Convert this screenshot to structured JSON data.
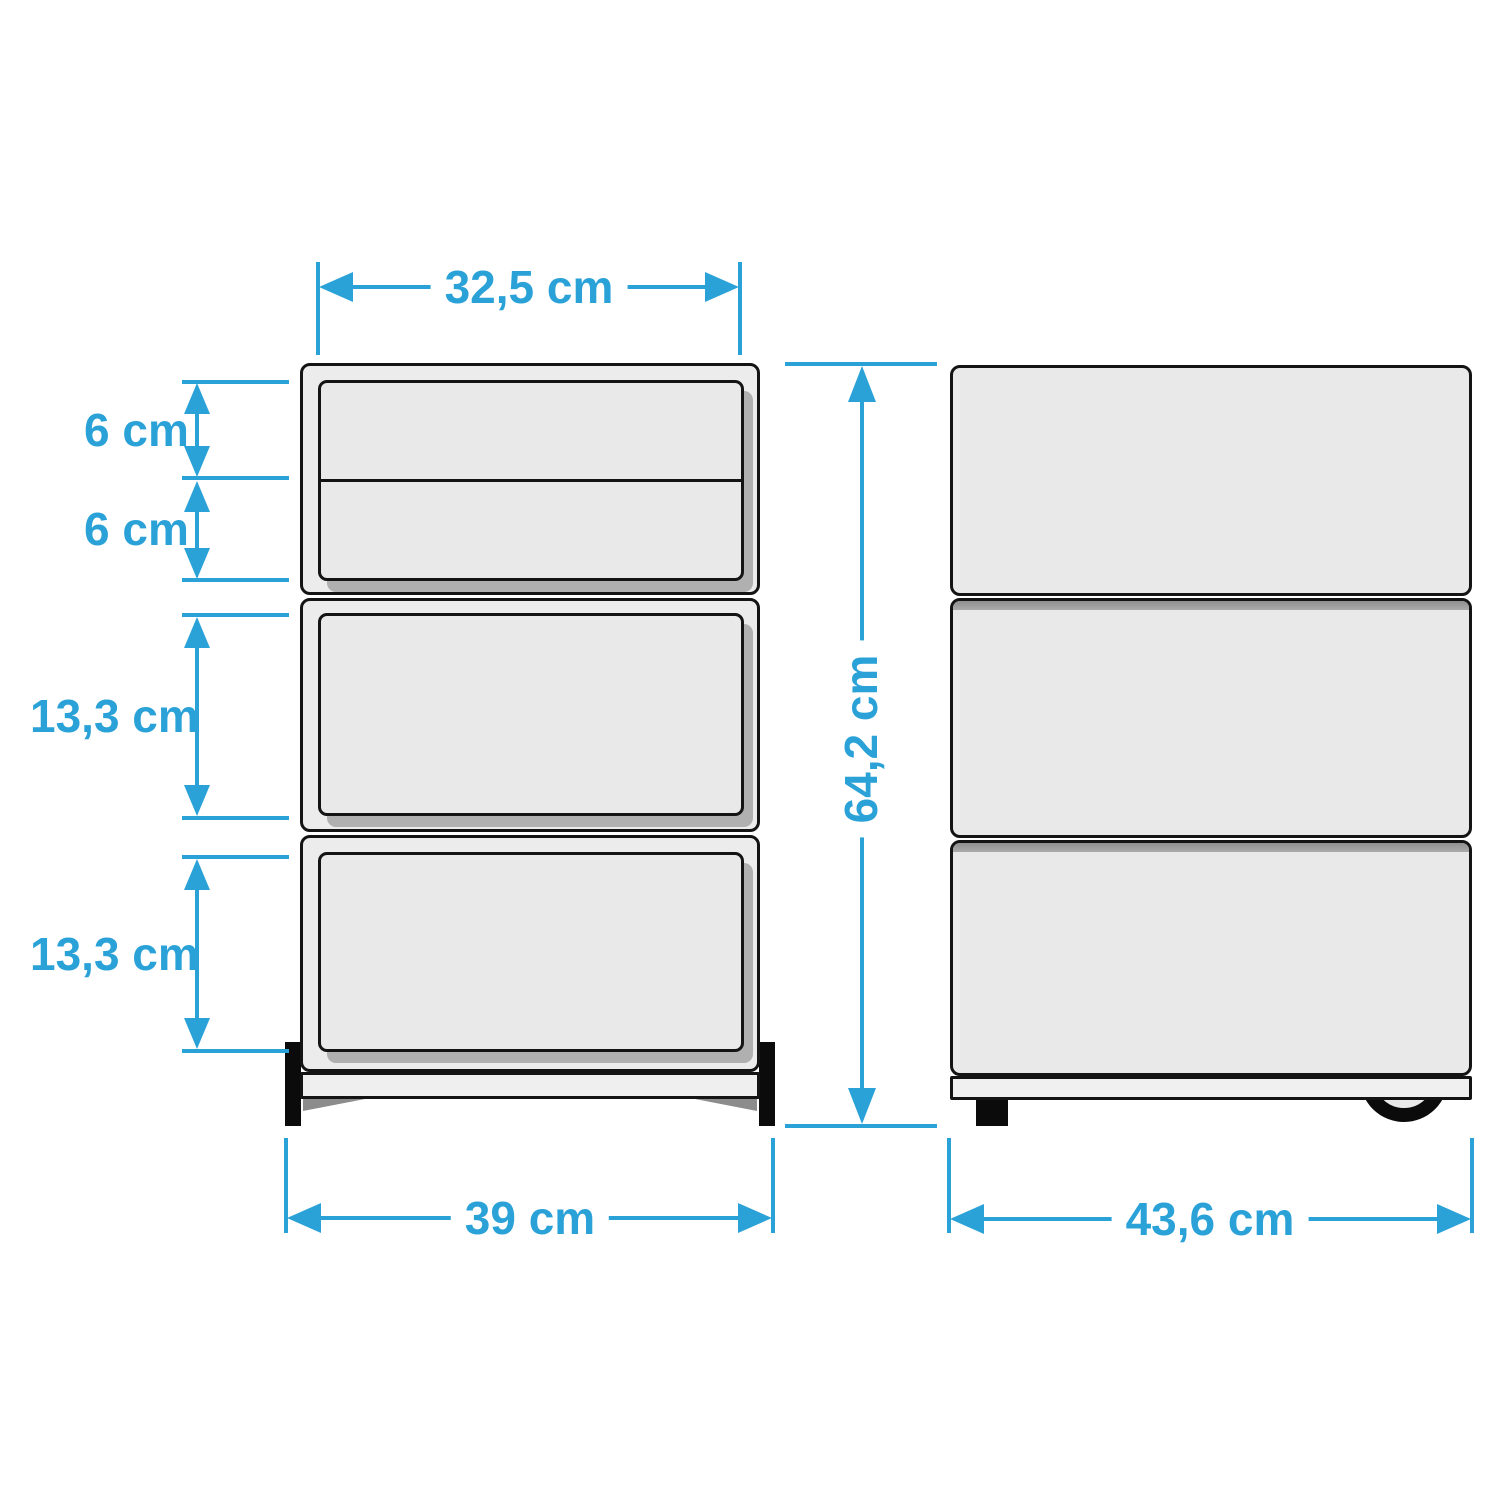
{
  "diagram_type": "furniture-dimension-drawing",
  "views": {
    "front": "drawer-cabinet-front-view",
    "side": "drawer-cabinet-side-view"
  },
  "colors": {
    "dimension_accent": "#2AA2D8",
    "outline": "#141414",
    "body_fill": "#ECECEC",
    "drawer_fill": "#E9E9E9",
    "shadow_gray": "#B0B0B0",
    "separator_gray": "#A3A3A3",
    "background": "#FFFFFF"
  },
  "dimensions": {
    "drawer_opening_width": "32,5 cm",
    "top_small_drawer_height": "6 cm",
    "second_small_drawer_height": "6 cm",
    "middle_drawer_height": "13,3 cm",
    "bottom_drawer_height": "13,3 cm",
    "overall_height": "64,2 cm",
    "overall_width": "39 cm",
    "overall_depth": "43,6 cm"
  }
}
